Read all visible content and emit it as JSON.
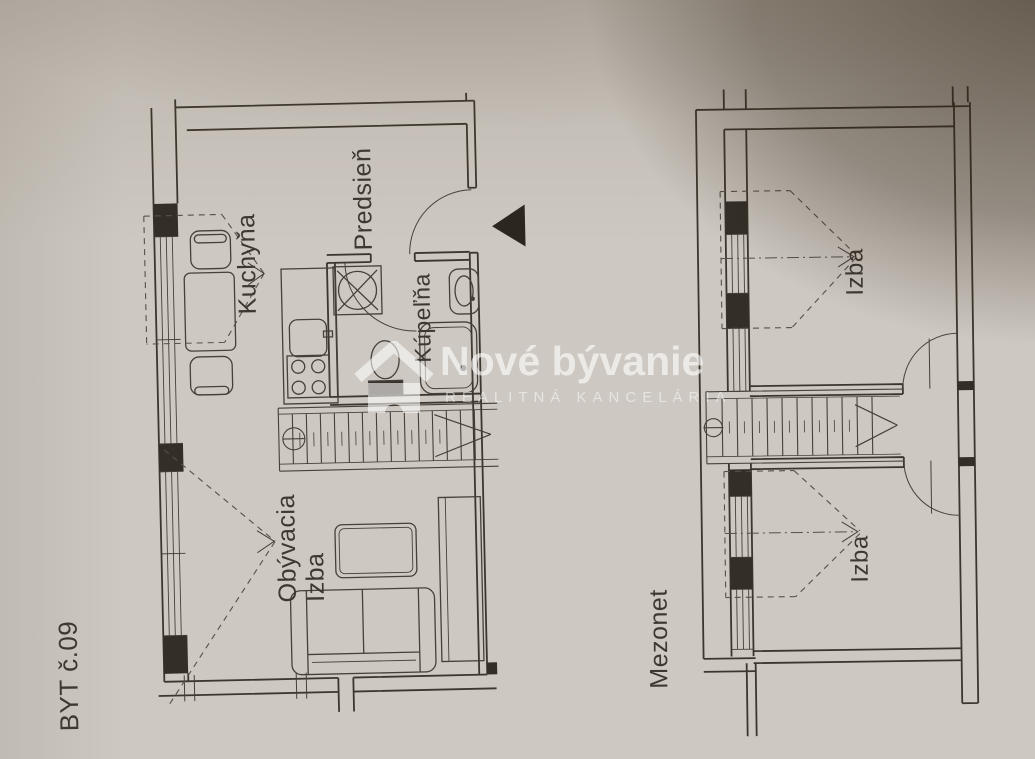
{
  "plans": {
    "byt": {
      "title": "BYT č.09",
      "rooms": [
        {
          "name": "kitchen",
          "label": "Kuchyňa"
        },
        {
          "name": "hallway",
          "label": "Predsieň"
        },
        {
          "name": "bathroom",
          "label": "Kúpeľňa"
        },
        {
          "name": "living-room",
          "label": "Obývacia\nIzba"
        }
      ]
    },
    "mezonet": {
      "title": "Mezonet",
      "rooms": [
        {
          "name": "room-upper",
          "label": "Izba"
        },
        {
          "name": "room-lower",
          "label": "Izba"
        }
      ]
    }
  },
  "watermark": {
    "title": "Nové bývanie",
    "subtitle": "REALITNÁ KANCELÁRIA"
  },
  "colors": {
    "paper": "#cdc8c1",
    "ink": "#46403a",
    "wall_fill": "#332e27",
    "shadow": "#2b1e0f",
    "watermark": "#ffffff"
  }
}
